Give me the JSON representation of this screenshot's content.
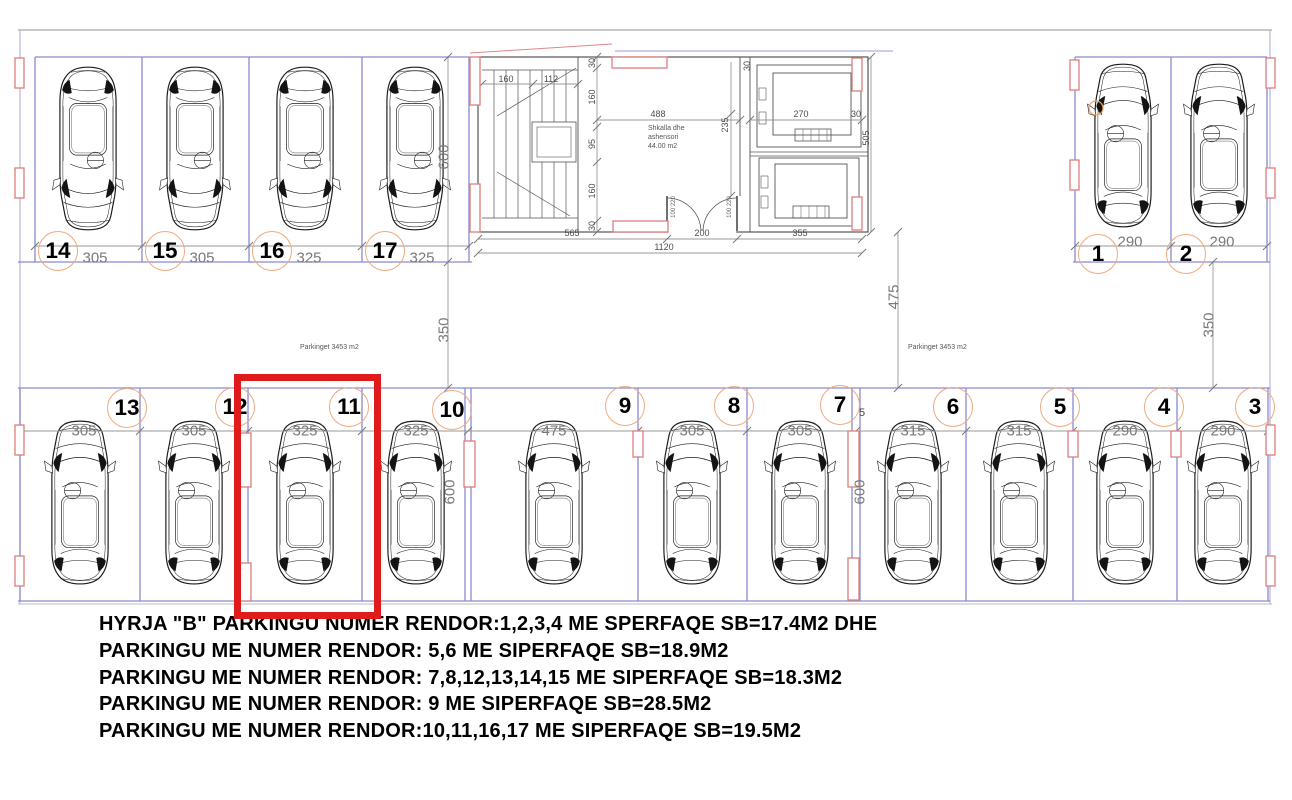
{
  "colors": {
    "highlight_red": "#df1b1b",
    "wall_red": "#e07d7d",
    "stall_blue": "#8a8ad2",
    "dim_gray": "#8c8c8c",
    "badge_orange": "#efaa7d"
  },
  "stalls": {
    "highlighted": "11",
    "top_left": [
      {
        "num": "14",
        "width_cm": "305"
      },
      {
        "num": "15",
        "width_cm": "305"
      },
      {
        "num": "16",
        "width_cm": "325"
      },
      {
        "num": "17",
        "width_cm": "325"
      }
    ],
    "top_right": [
      {
        "num": "1",
        "width_cm": "290"
      },
      {
        "num": "2",
        "width_cm": "290"
      }
    ],
    "bottom": [
      {
        "num": "13",
        "width_cm": "305"
      },
      {
        "num": "12",
        "width_cm": "305"
      },
      {
        "num": "11",
        "width_cm": "325"
      },
      {
        "num": "10",
        "width_cm": "325"
      },
      {
        "num": "9",
        "width_cm": "475"
      },
      {
        "num": "8",
        "width_cm": "305"
      },
      {
        "num": "7",
        "width_cm": "305"
      },
      {
        "num": "6",
        "width_cm": "315"
      },
      {
        "num": "5",
        "width_cm": "315"
      },
      {
        "num": "4",
        "width_cm": "290"
      },
      {
        "num": "3",
        "width_cm": "290"
      }
    ]
  },
  "core": {
    "label": "Shkalla dhe\nashensori\n44.00 m2",
    "dims": {
      "stair_a": "160",
      "stair_b": "112",
      "lobby_w": "488",
      "wall_v": "235",
      "lift_w": "270",
      "left_chain": [
        "30",
        "160",
        "95",
        "160",
        "30"
      ],
      "thirties": [
        "30",
        "30"
      ],
      "door": "100 220",
      "bottom_chain": [
        "565",
        "200",
        "355"
      ],
      "bottom_total": "1120",
      "right_height": "505"
    }
  },
  "site": {
    "left_depth": "600",
    "left_aisle": "350",
    "mid_aisle": "475",
    "right_aisle": "350",
    "bottom_depth_a": "600",
    "bottom_depth_b": "600",
    "wall_gap": "5",
    "area_left": "Parkinget 3453 m2",
    "area_right": "Parkinget 3453 m2"
  },
  "notes": [
    "HYRJA  \"B\" PARKINGU NUMER  RENDOR:1,2,3,4  ME SPERFAQE SB=17.4M2 DHE",
    "PARKINGU ME NUMER RENDOR: 5,6 ME SIPERFAQE  SB=18.9M2",
    "PARKINGU ME NUMER RENDOR: 7,8,12,13,14,15 ME SIPERFAQE  SB=18.3M2",
    "PARKINGU ME NUMER RENDOR: 9  ME SIPERFAQE  SB=28.5M2",
    "PARKINGU ME NUMER RENDOR:10,11,16,17  ME SIPERFAQE  SB=19.5M2"
  ]
}
